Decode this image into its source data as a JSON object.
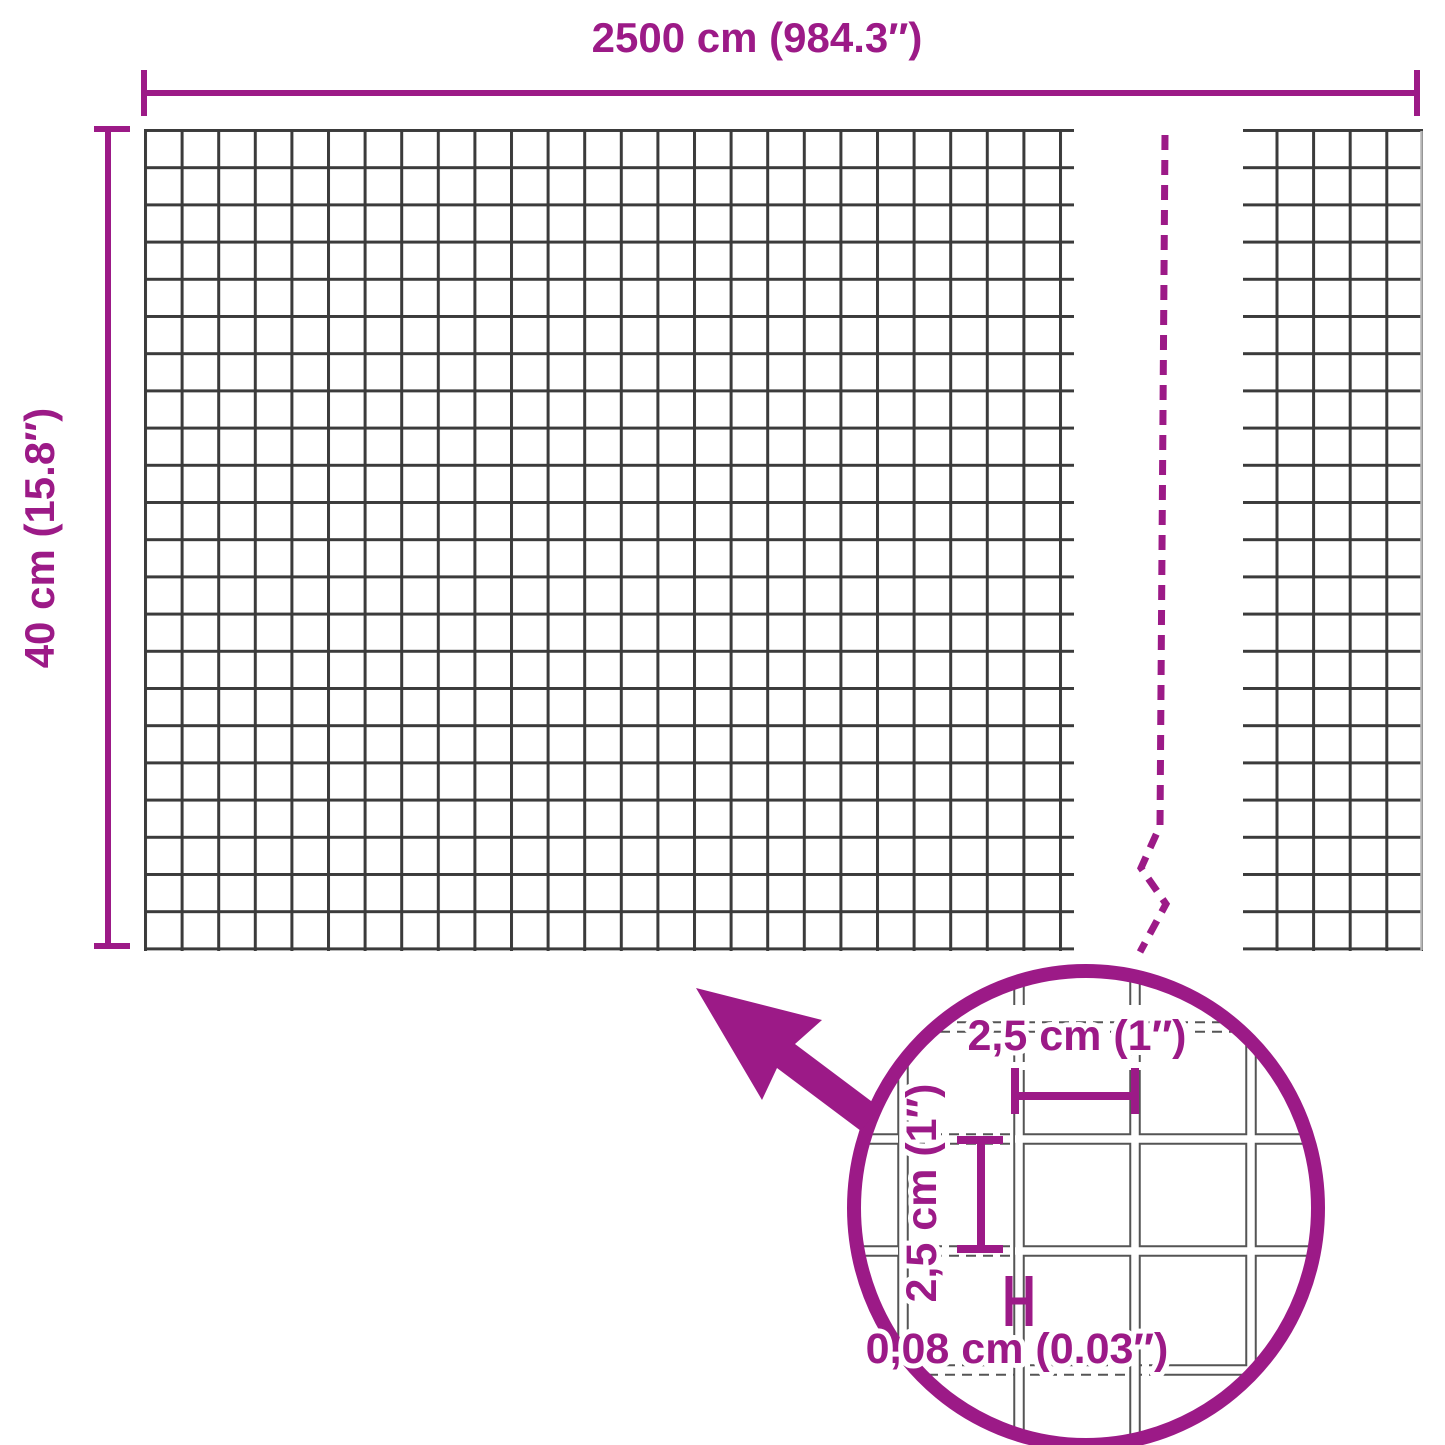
{
  "diagram": {
    "type": "product-dimension-diagram",
    "subject": "welded wire mesh roll with zoom detail",
    "overall": {
      "width_label": "2500 cm (984.3″)",
      "height_label": "40 cm (15.8″)"
    },
    "detail": {
      "opening_width_label": "2,5 cm (1″)",
      "opening_height_label": "2,5 cm (1″)",
      "wire_thickness_label": "0,08 cm (0.03″)"
    },
    "colors": {
      "accent": "#9c1a87",
      "grid_line": "#3b3b3b",
      "detail_wire": "#555555",
      "leader": "#777777",
      "cut_edge": "#b5b5b5",
      "background": "#ffffff"
    }
  }
}
